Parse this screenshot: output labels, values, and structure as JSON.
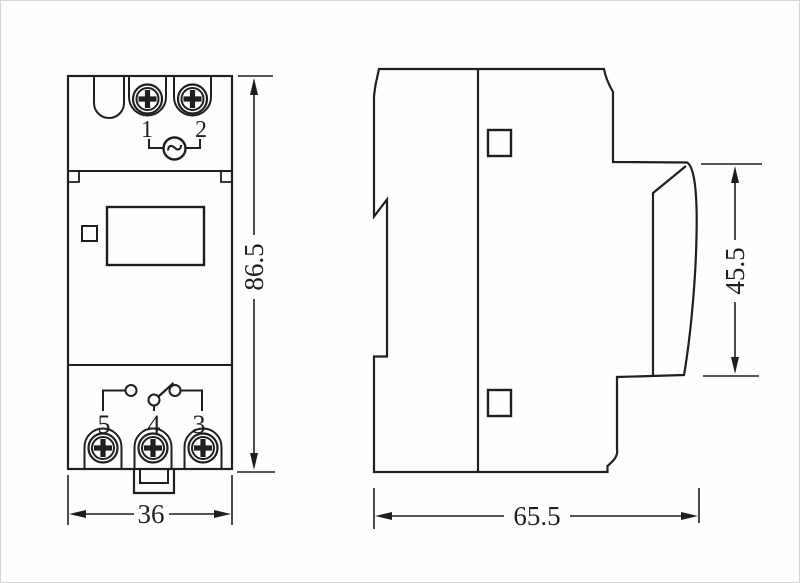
{
  "drawing": {
    "front_view": {
      "top_terminal_labels": [
        "1",
        "2"
      ],
      "bottom_terminal_labels": [
        "5",
        "4",
        "3"
      ],
      "ac_symbol": "~",
      "width_dim": "36",
      "height_dim": "86.5"
    },
    "side_view": {
      "depth_dim": "65.5",
      "rail_section_height_dim": "45.5"
    },
    "colors": {
      "line": "#1f1f1f",
      "background": "#fefefe"
    }
  }
}
